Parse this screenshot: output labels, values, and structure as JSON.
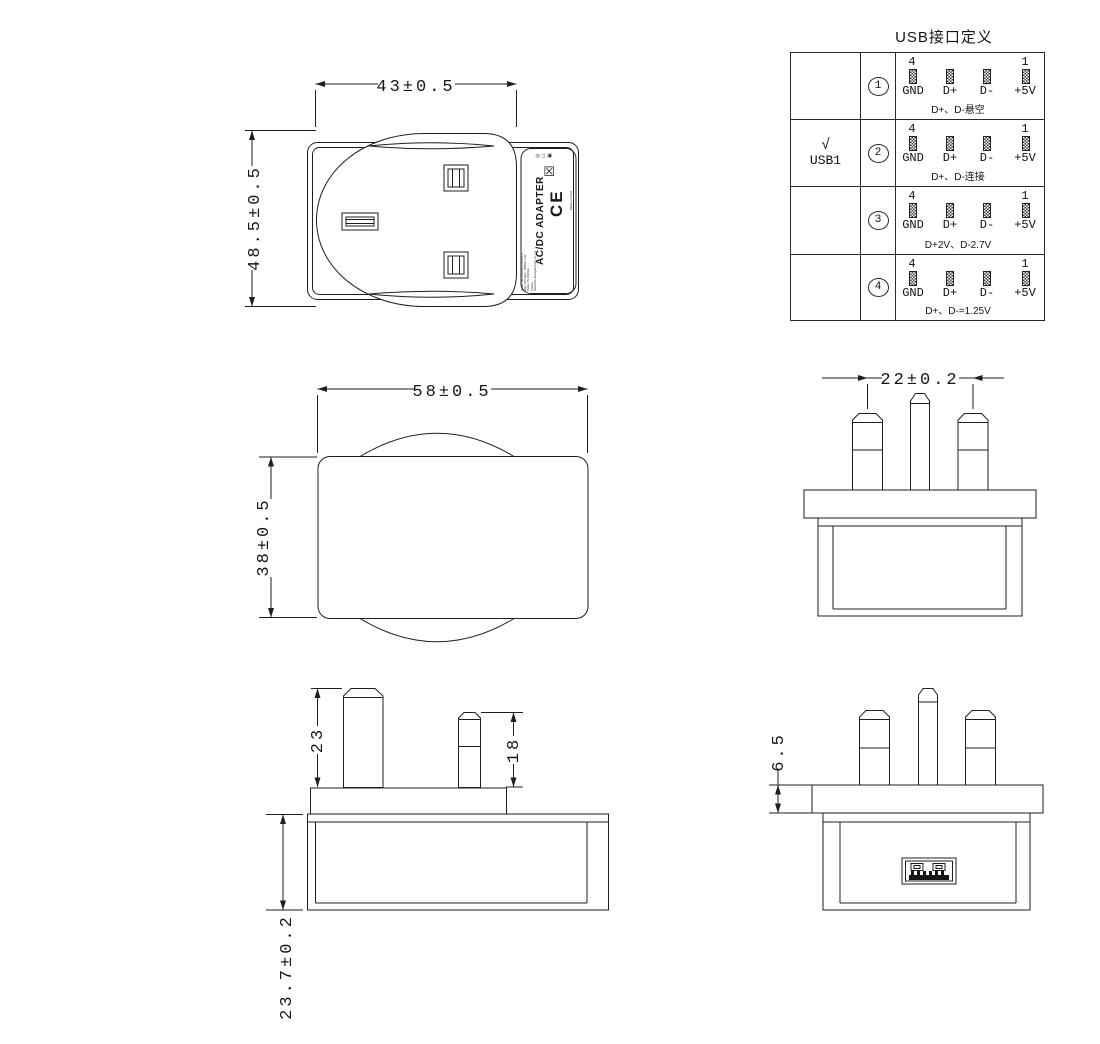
{
  "sheet": {
    "background": "#ffffff",
    "line_color": "#1f1f1f"
  },
  "dimensions": {
    "front_view": {
      "width_dim": "43±0.5",
      "height_dim": "48.5±0.5"
    },
    "side_view": {
      "width_dim": "58±0.5",
      "height_dim": "38±0.5"
    },
    "top_view": {
      "pin_spacing_dim": "22±0.2"
    },
    "pin_profile_view": {
      "earth_pin_length_dim": "23",
      "power_pin_length_dim": "18",
      "body_depth_dim": "23.7±0.2"
    },
    "bottom_view": {
      "flange_thickness_dim": "6.5"
    }
  },
  "product_label": {
    "title": "AC/DC ADAPTER",
    "print_lines": [
      "Model: JB9-0501000-XXXXXX-A",
      "Input: 100-240V~ 50/60Hz 0.4A",
      "Output: 5V 2000mA",
      "Polarity:",
      "Shenzhen Jihongda Power Co.,Ltd"
    ],
    "ce_mark": "CE",
    "made_in": "Made in China",
    "weee_glyph": "☒",
    "cert_glyphs": {
      "circle": "◎",
      "bin": "▭",
      "box": "▣"
    }
  },
  "usb_table": {
    "title": "USB接口定义",
    "first_pin_number": "4",
    "last_pin_number": "1",
    "pin_labels": [
      "GND",
      "D+",
      "D-",
      "+5V"
    ],
    "rows": [
      {
        "index": "1",
        "check": "",
        "port": "",
        "note": "D+、D-悬空"
      },
      {
        "index": "2",
        "check": "√",
        "port": "USB1",
        "note": "D+、D-连接"
      },
      {
        "index": "3",
        "check": "",
        "port": "",
        "note": "D+2V、D-2.7V"
      },
      {
        "index": "4",
        "check": "",
        "port": "",
        "note": "D+、D-=1.25V"
      }
    ]
  }
}
